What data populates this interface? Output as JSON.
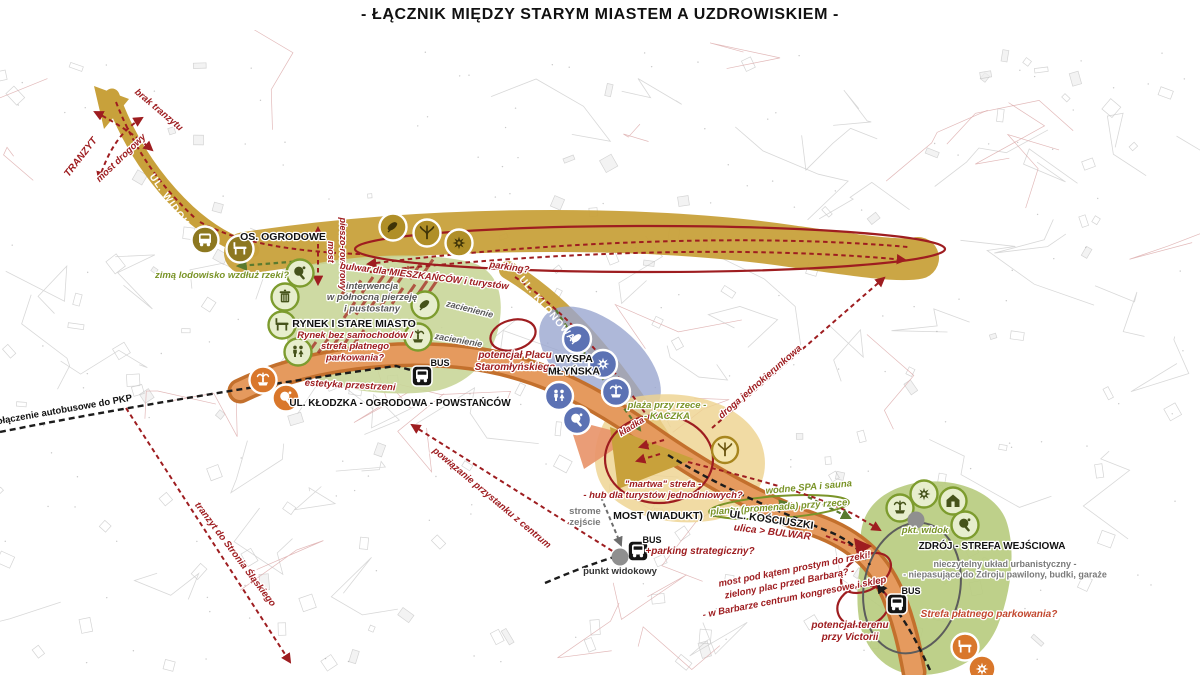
{
  "title": "- ŁĄCZNIK MIĘDZY STARYM MIASTEM A UZDROWISKIEM -",
  "colors": {
    "tan": "#c8a13b",
    "tanDark": "#8d7820",
    "red": "#9e1d20",
    "red2": "#c2482f",
    "olive": "#7a9428",
    "oliveDark": "#46531b",
    "greenZone": "#c9d699",
    "greenZone2": "#b9cc80",
    "blueIcon": "#5c72b4",
    "blueZone": "#9aa6cf",
    "orangeIcon": "#d9772b",
    "orangeRoad": "#e59a5e",
    "orangeEdge": "#c3702d",
    "yellowZone": "#eed390",
    "grayNote": "#7a7a7a",
    "black": "#1a1a1a"
  },
  "map": {
    "labels": [
      {
        "id": "brak-tranzytu",
        "text": "brak tranzytu",
        "x": 157,
        "y": 112,
        "rot": 40,
        "style": "red",
        "size": 9.5
      },
      {
        "id": "tranzyt",
        "text": "TRANZYT",
        "x": 83,
        "y": 159,
        "rot": -52,
        "style": "red",
        "size": 10
      },
      {
        "id": "most-drogowy",
        "text": "most drogowy",
        "x": 123,
        "y": 160,
        "rot": -44,
        "style": "red",
        "size": 9.5
      },
      {
        "id": "ul-widok",
        "text": "UL. WIDOK",
        "x": 167,
        "y": 202,
        "rot": 55,
        "style": "road",
        "size": 10
      },
      {
        "id": "os-ogrodowe",
        "text": "OS. OGRODOWE",
        "x": 283,
        "y": 240,
        "rot": 0,
        "style": "black",
        "size": 10.5
      },
      {
        "id": "zima-lodowisko",
        "text": "zimą lodowisko wzdłuż rzeki?",
        "x": 222,
        "y": 278,
        "rot": 0,
        "style": "green",
        "size": 9.5
      },
      {
        "id": "most-pieszo-1",
        "text": "pieszo-rowerowy",
        "x": 340,
        "y": 254,
        "rot": 90,
        "style": "red",
        "size": 9
      },
      {
        "id": "most-pieszo-2",
        "text": "most",
        "x": 328,
        "y": 252,
        "rot": 90,
        "style": "red",
        "size": 9
      },
      {
        "id": "bulwar",
        "text": "bulwar dla MIESZKAŃCÓW i turystów",
        "x": 424,
        "y": 279,
        "rot": 7,
        "style": "red",
        "size": 9.5
      },
      {
        "id": "parking",
        "text": "parking?",
        "x": 509,
        "y": 270,
        "rot": 8,
        "style": "red",
        "size": 9.5
      },
      {
        "id": "zacienienie-1",
        "text": "zacienienie",
        "x": 469,
        "y": 312,
        "rot": 14,
        "style": "graydark",
        "size": 9
      },
      {
        "id": "zacienienie-2",
        "text": "zacienienie",
        "x": 458,
        "y": 343,
        "rot": 10,
        "style": "graydark",
        "size": 9
      },
      {
        "id": "interwencja",
        "lines": [
          "interwencja",
          "w północną pierzeję",
          "i pustostany"
        ],
        "x": 372,
        "y": 289,
        "rot": 0,
        "style": "graydark",
        "size": 9.5
      },
      {
        "id": "rynek-stare-miasto",
        "text": "RYNEK I STARE MIASTO",
        "x": 354,
        "y": 327,
        "rot": 0,
        "style": "black",
        "size": 10.5
      },
      {
        "id": "rynek-bez",
        "lines": [
          "Rynek bez samochodów /",
          "strefa płatnego",
          "parkowania?"
        ],
        "x": 355,
        "y": 338,
        "rot": 0,
        "style": "red",
        "size": 9.5
      },
      {
        "id": "bus-1",
        "text": "BUS",
        "x": 440,
        "y": 366,
        "rot": 0,
        "style": "black",
        "size": 9
      },
      {
        "id": "estetyka",
        "text": "estetyka przestrzeni",
        "x": 350,
        "y": 388,
        "rot": 3,
        "style": "red",
        "size": 9.5
      },
      {
        "id": "ul-klodzka",
        "text": "UL. KŁODZKA - OGRODOWA - POWSTAŃCÓW",
        "x": 400,
        "y": 406,
        "rot": 0,
        "style": "black",
        "size": 10
      },
      {
        "id": "polaczenie-pkp",
        "text": "połączenie autobusowe do PKP",
        "x": 62,
        "y": 413,
        "rot": -10,
        "style": "black",
        "size": 9.5
      },
      {
        "id": "tranzyt-stronie",
        "text": "tranzyt do Stronia Śląskiego",
        "x": 233,
        "y": 556,
        "rot": 53,
        "style": "red",
        "size": 9.5
      },
      {
        "id": "potencjal-placu",
        "lines": [
          "potencjał Placu",
          "Staromłyńskiego"
        ],
        "x": 515,
        "y": 358,
        "rot": 0,
        "style": "red",
        "size": 10
      },
      {
        "id": "wyspa-mlynska",
        "lines": [
          "WYSPA",
          "MŁYŃSKA"
        ],
        "x": 574,
        "y": 362,
        "rot": 0,
        "style": "black",
        "size": 10.5
      },
      {
        "id": "ul-klonowa",
        "text": "UL. KLONOWA",
        "x": 545,
        "y": 311,
        "rot": 50,
        "style": "road",
        "size": 10
      },
      {
        "id": "plaza-kaczka",
        "lines": [
          "plaża przy rzece -",
          "- KACZKA"
        ],
        "x": 667,
        "y": 408,
        "rot": 0,
        "style": "green",
        "size": 9.5
      },
      {
        "id": "kladka",
        "text": "kładka",
        "x": 633,
        "y": 429,
        "rot": -32,
        "style": "red",
        "size": 9
      },
      {
        "id": "droga-jedno",
        "text": "droga jednokierunkowa",
        "x": 762,
        "y": 384,
        "rot": -41,
        "style": "red",
        "size": 9.5
      },
      {
        "id": "martwa",
        "lines": [
          "\"martwa\" strefa -",
          "- hub dla turystów jednodniowych?"
        ],
        "x": 663,
        "y": 487,
        "rot": 0,
        "style": "red",
        "size": 9.5
      },
      {
        "id": "wodne-spa",
        "text": "wodne SPA i sauna",
        "x": 809,
        "y": 490,
        "rot": -5,
        "style": "green",
        "size": 9.5
      },
      {
        "id": "planty",
        "text": "planty (promenada) przy rzece",
        "x": 779,
        "y": 510,
        "rot": -4,
        "style": "green",
        "size": 9.5
      },
      {
        "id": "most-wiadukt",
        "text": "MOST (WIADUKT)",
        "x": 658,
        "y": 519,
        "rot": 0,
        "style": "black",
        "size": 10.5
      },
      {
        "id": "ul-kosciuszki",
        "text": "UL. KOŚCIUSZKI",
        "x": 771,
        "y": 523,
        "rot": 8,
        "style": "black",
        "size": 10.5
      },
      {
        "id": "ulica-bulwar",
        "text": "ulica > BULWAR",
        "x": 772,
        "y": 535,
        "rot": 7,
        "style": "red",
        "size": 10
      },
      {
        "id": "strome",
        "lines": [
          "strome",
          "zejście"
        ],
        "x": 585,
        "y": 514,
        "rot": 0,
        "style": "graynote",
        "size": 9.5
      },
      {
        "id": "bus-2",
        "text": "BUS",
        "x": 652,
        "y": 543,
        "rot": 0,
        "style": "black",
        "size": 9
      },
      {
        "id": "parking-strat",
        "text": "+parking strategiczny?",
        "x": 700,
        "y": 554,
        "rot": 0,
        "style": "red",
        "size": 10
      },
      {
        "id": "punkt-widokowy",
        "text": "punkt widokowy",
        "x": 620,
        "y": 574,
        "rot": 0,
        "style": "dark",
        "size": 9.5
      },
      {
        "id": "powiazanie",
        "text": "powiązanie przystanku z centrum",
        "x": 490,
        "y": 500,
        "rot": 40,
        "style": "red",
        "size": 9.5
      },
      {
        "id": "zdroj",
        "text": "ZDRÓJ - STREFA WEJŚCIOWA",
        "x": 992,
        "y": 549,
        "rot": 0,
        "style": "black",
        "size": 10
      },
      {
        "id": "pkt-widok",
        "text": "pkt. widok",
        "x": 925,
        "y": 533,
        "rot": 0,
        "style": "green",
        "size": 9.5
      },
      {
        "id": "nieczytelny",
        "lines": [
          "nieczytelny układ urbanistyczny -",
          "- niepasujące do Zdroju pawilony, budki, garaże"
        ],
        "x": 1005,
        "y": 567,
        "rot": 0,
        "style": "graynote",
        "size": 9
      },
      {
        "id": "most-pod-katem",
        "text": "most pod kątem prostym do rzeki!",
        "x": 795,
        "y": 572,
        "rot": -11,
        "style": "red",
        "size": 9.5
      },
      {
        "id": "zielony-plac",
        "text": "zielony plac przed Barbarą? -",
        "x": 790,
        "y": 586,
        "rot": -11,
        "style": "red",
        "size": 9.5
      },
      {
        "id": "w-barbarze",
        "text": "- w Barbarze centrum kongresowe i sklep",
        "x": 795,
        "y": 600,
        "rot": -11,
        "style": "red",
        "size": 9.5
      },
      {
        "id": "potencjal-victorii",
        "lines": [
          "potencjał terenu",
          "przy Victorii"
        ],
        "x": 850,
        "y": 628,
        "rot": 0,
        "style": "red",
        "size": 10
      },
      {
        "id": "bus-3",
        "text": "BUS",
        "x": 911,
        "y": 594,
        "rot": 0,
        "style": "black",
        "size": 9
      },
      {
        "id": "strefa-platnego",
        "text": "Strefa płatnego parkowania?",
        "x": 989,
        "y": 617,
        "rot": 0,
        "style": "red2",
        "size": 10
      }
    ],
    "markers": [
      {
        "id": "stop-widok",
        "icon": "bus",
        "style": "tan",
        "x": 205,
        "y": 240
      },
      {
        "id": "bench-widok",
        "icon": "bench",
        "style": "tan",
        "x": 240,
        "y": 249
      },
      {
        "id": "leaf-band",
        "icon": "leaf",
        "style": "tan2",
        "x": 393,
        "y": 227
      },
      {
        "id": "tree-band",
        "icon": "tree",
        "style": "tan2",
        "x": 427,
        "y": 233
      },
      {
        "id": "flower-band",
        "icon": "flower",
        "style": "tan2",
        "x": 459,
        "y": 243
      },
      {
        "id": "paddle-rynek",
        "icon": "paddle",
        "style": "green",
        "x": 300,
        "y": 273
      },
      {
        "id": "trash-rynek",
        "icon": "trash",
        "style": "green",
        "x": 285,
        "y": 297
      },
      {
        "id": "bench-rynek",
        "icon": "bench",
        "style": "green",
        "x": 282,
        "y": 325
      },
      {
        "id": "wc-rynek",
        "icon": "wc",
        "style": "green",
        "x": 298,
        "y": 352
      },
      {
        "id": "leaf-rynek",
        "icon": "leaf",
        "style": "green",
        "x": 425,
        "y": 305
      },
      {
        "id": "fountain-rynek",
        "icon": "fountain",
        "style": "green",
        "x": 418,
        "y": 337
      },
      {
        "id": "fountain-klodzka",
        "icon": "fountain",
        "style": "orange",
        "x": 263,
        "y": 380
      },
      {
        "id": "paddle-klodzka",
        "icon": "paddle",
        "style": "orange",
        "x": 286,
        "y": 398
      },
      {
        "id": "leaf-wyspa",
        "icon": "leaf",
        "style": "blue",
        "x": 577,
        "y": 339
      },
      {
        "id": "flower-wyspa",
        "icon": "flower",
        "style": "blue",
        "x": 603,
        "y": 364
      },
      {
        "id": "wc-wyspa",
        "icon": "wc",
        "style": "blue",
        "x": 559,
        "y": 396
      },
      {
        "id": "fountain-wyspa",
        "icon": "fountain",
        "style": "blue",
        "x": 616,
        "y": 392
      },
      {
        "id": "paddle-wyspa",
        "icon": "paddle",
        "style": "blue",
        "x": 577,
        "y": 420
      },
      {
        "id": "tree-kaczka",
        "icon": "tree",
        "style": "yellow",
        "x": 725,
        "y": 450
      },
      {
        "id": "fountain-zdroj",
        "icon": "fountain",
        "style": "green",
        "x": 900,
        "y": 508
      },
      {
        "id": "flower-zdroj",
        "icon": "flower",
        "style": "green",
        "x": 924,
        "y": 494
      },
      {
        "id": "house-zdroj",
        "icon": "house",
        "style": "green",
        "x": 953,
        "y": 501
      },
      {
        "id": "paddle-zdroj",
        "icon": "paddle",
        "style": "green",
        "x": 965,
        "y": 525
      },
      {
        "id": "bench-victoria",
        "icon": "bench",
        "style": "orange",
        "x": 965,
        "y": 647
      },
      {
        "id": "flower-victoria",
        "icon": "flower",
        "style": "orange",
        "x": 982,
        "y": 669
      },
      {
        "id": "bus-stop-klodzka",
        "icon": "bus",
        "style": "busblack",
        "x": 422,
        "y": 376
      },
      {
        "id": "bus-stop-most",
        "icon": "bus",
        "style": "busblack",
        "x": 638,
        "y": 551
      },
      {
        "id": "bus-stop-zdroj",
        "icon": "bus",
        "style": "busblack",
        "x": 897,
        "y": 604
      },
      {
        "id": "viewpoint-most",
        "icon": "dot",
        "style": "graydot",
        "x": 620,
        "y": 557
      },
      {
        "id": "viewpoint-zdroj",
        "icon": "dot",
        "style": "graydot",
        "x": 916,
        "y": 520
      }
    ]
  }
}
